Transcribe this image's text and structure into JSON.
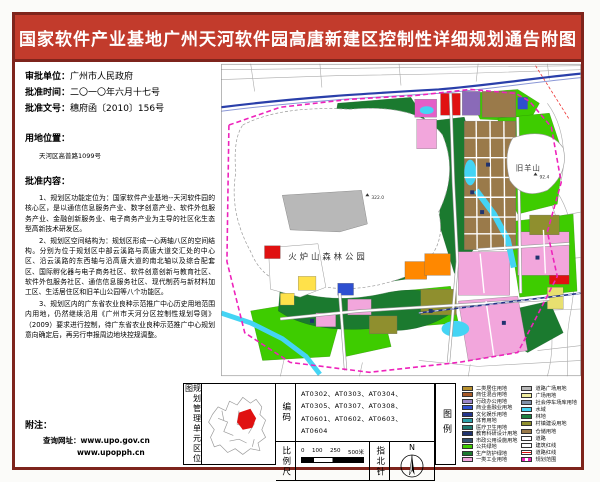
{
  "title": "国家软件产业基地广州天河软件园高唐新建区控制性详细规划通告附图",
  "colors": {
    "banner": "#c23b2c",
    "frame": "#7e241c",
    "boundary": "#ee22bb"
  },
  "info": {
    "approval_unit_label": "审批单位：",
    "approval_unit": "广州市人民政府",
    "approval_date_label": "批准时间：",
    "approval_date": "二〇一〇年六月十七号",
    "approval_doc_label": "批准文号：",
    "approval_doc": "穗府函〔2010〕156号",
    "location_label": "用地位置：",
    "location": "天河区高普路1099号",
    "content_label": "批准内容：",
    "paragraphs": [
      "1、规划区功能定位为：国家软件产业基地--天河软件园的核心区，是以通信信息服务产业、数字创意产业、软件外包服务产业、金融创新服务业、电子商务产业为主导的社区化生态型高新技术研发区。",
      "2、规划区空间结构为：规划区形成一心两轴八区的空间结构。分别为位于规划区中部云溪路与高唐大道交汇处的中心区、沿云溪路的东西轴与沿高唐大道的南北轴以及综合配套区、国际孵化器与电子商务社区、软件创意创新与教育社区、软件外包服务社区、通信信息服务社区、现代制药与新材料加工区、生活居住区和旧羊山公园等八个功能区。",
      "3、规划区内的广东省农业良种示范推广中心历史用地范围内用地，仍然继续沿用《广州市天河分区控制性规划导则》（2009）要求进行控制，待广东省农业良种示范推广中心规划意向确定后，再另行申报周边地块控规调整。"
    ],
    "notes_label": "附注：",
    "query_line": "查询网址：www.upo.gov.cn",
    "query_line2": "www.upopph.cn"
  },
  "map": {
    "labels": {
      "park": "火炉山森林公园",
      "hill": "旧羊山",
      "peak1": "322.0",
      "peak2": "92.4"
    }
  },
  "footer": {
    "unit_map_label": "规划管理单元区位图",
    "code_label": "编码",
    "codes": "AT0302、AT0303、AT0304、AT0305、AT0307、AT0308、AT0601、AT0602、AT0603、AT0604",
    "scale_label": "比例尺",
    "scale_ticks": [
      "0",
      "100",
      "250",
      "500米"
    ],
    "north_label": "指北针",
    "north_n": "N",
    "legend_label": "图例",
    "legend_left": [
      {
        "color": "#b8912f",
        "label": "二类居住用地"
      },
      {
        "color": "#a85a28",
        "label": "商住混合用地"
      },
      {
        "color": "#9a86c8",
        "label": "行政办公用地"
      },
      {
        "color": "#2e4fd0",
        "label": "商业金融业用地"
      },
      {
        "color": "#24368e",
        "label": "文化娱乐用地"
      },
      {
        "color": "#2aa0a8",
        "label": "体育用地"
      },
      {
        "color": "#1f7a70",
        "label": "医疗卫生用地"
      },
      {
        "color": "#20336e",
        "label": "教育科研设计用地"
      },
      {
        "color": "#33506e",
        "label": "市政公用设施用地"
      },
      {
        "color": "#3ecc00",
        "label": "公共绿地"
      },
      {
        "color": "#1b7a2f",
        "label": "生产防护绿地"
      },
      {
        "color": "#f2a6dc",
        "label": "一类工业用地"
      }
    ],
    "legend_right": [
      {
        "color": "#b8b8b8",
        "label": "道路广场用地"
      },
      {
        "color": "#f0eda0",
        "label": "广场用地"
      },
      {
        "color": "#8090a8",
        "label": "社会停车场库用地"
      },
      {
        "color": "#44d4f4",
        "label": "水域"
      },
      {
        "color": "#1e8040",
        "label": "林地"
      },
      {
        "color": "#8f8f2e",
        "label": "村镇建设用地"
      },
      {
        "color": "#9a7a4a",
        "label": "仓储用地"
      },
      {
        "color": "#ffffff",
        "label": "道路"
      },
      {
        "color": "#ffffff",
        "label": "建筑红线"
      },
      {
        "color": "#e01111",
        "type": "line",
        "label": "道路红线"
      },
      {
        "color": "#ee22bb",
        "type": "dash",
        "label": "规划范围"
      }
    ]
  }
}
